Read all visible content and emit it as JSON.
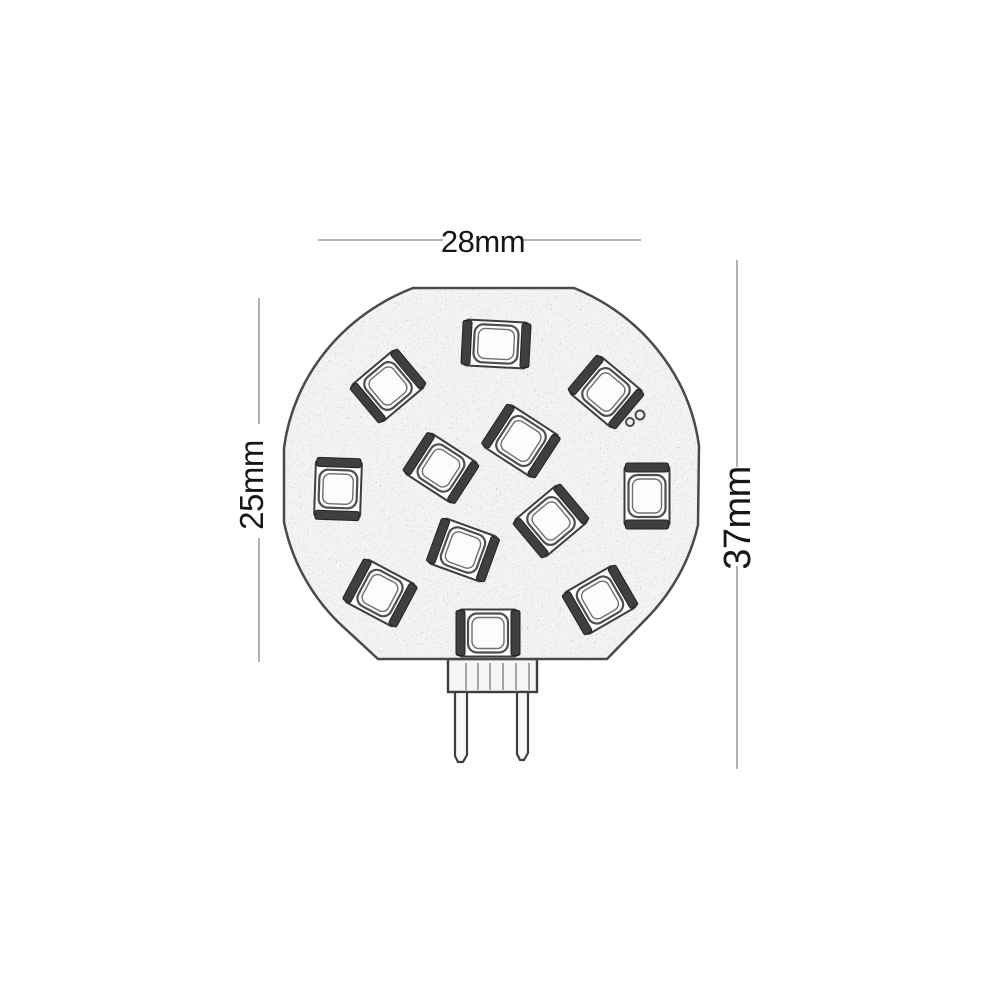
{
  "dimensions": {
    "width": "28mm",
    "disc_height": "25mm",
    "total_height": "37mm"
  },
  "diagram": {
    "type": "technical-drawing",
    "subject": "G4 side-pin LED disc bulb",
    "led_count": 12,
    "background": "#ffffff",
    "ink_color": "#3f3f3f",
    "dim_line_color": "#9c9c9c",
    "disc_fill": "#f3f3f1",
    "disc_path": "M 413 288 L 574 288 A 209 199 0 0 1 699 446 L 698 525 A 209 199 0 0 1 645 620 L 607 659 L 378 659 L 338 622 A 209 199 0 0 1 284 522 L 284 448 A 209 199 0 0 1 413 288 Z",
    "leds": [
      {
        "x": 496,
        "y": 344,
        "w": 64,
        "h": 46,
        "rot": 3
      },
      {
        "x": 388,
        "y": 386,
        "w": 58,
        "h": 48,
        "rot": -40
      },
      {
        "x": 606,
        "y": 392,
        "w": 58,
        "h": 48,
        "rot": 40
      },
      {
        "x": 521,
        "y": 441,
        "w": 60,
        "h": 50,
        "rot": 33
      },
      {
        "x": 441,
        "y": 468,
        "w": 58,
        "h": 48,
        "rot": 33
      },
      {
        "x": 338,
        "y": 489,
        "w": 58,
        "h": 46,
        "rot": 92
      },
      {
        "x": 647,
        "y": 496,
        "w": 62,
        "h": 45,
        "rot": 90
      },
      {
        "x": 551,
        "y": 521,
        "w": 58,
        "h": 48,
        "rot": -40
      },
      {
        "x": 463,
        "y": 550,
        "w": 58,
        "h": 48,
        "rot": 20
      },
      {
        "x": 380,
        "y": 593,
        "w": 57,
        "h": 48,
        "rot": 28
      },
      {
        "x": 600,
        "y": 600,
        "w": 58,
        "h": 48,
        "rot": -30
      },
      {
        "x": 488,
        "y": 633,
        "w": 60,
        "h": 47,
        "rot": 0
      }
    ],
    "solder_dots": [
      {
        "x": 630,
        "y": 422,
        "r": 4
      },
      {
        "x": 640,
        "y": 415,
        "r": 4.5
      }
    ],
    "connector": {
      "x": 448,
      "y": 659,
      "w": 89,
      "h": 33,
      "ridges": [
        466,
        478,
        490,
        503,
        516,
        529
      ]
    },
    "pins": [
      {
        "x": 455,
        "y": 692,
        "w": 12,
        "len": 70
      },
      {
        "x": 517,
        "y": 692,
        "w": 11,
        "len": 68
      }
    ],
    "dimension_lines": {
      "top": {
        "y": 240,
        "segments": [
          [
            318,
            443
          ],
          [
            523,
            641
          ]
        ]
      },
      "left": {
        "x": 259,
        "segments": [
          [
            298,
            424
          ],
          [
            538,
            662
          ]
        ]
      },
      "right": {
        "x": 737,
        "segments": [
          [
            260,
            467
          ],
          [
            566,
            769
          ]
        ]
      }
    }
  }
}
